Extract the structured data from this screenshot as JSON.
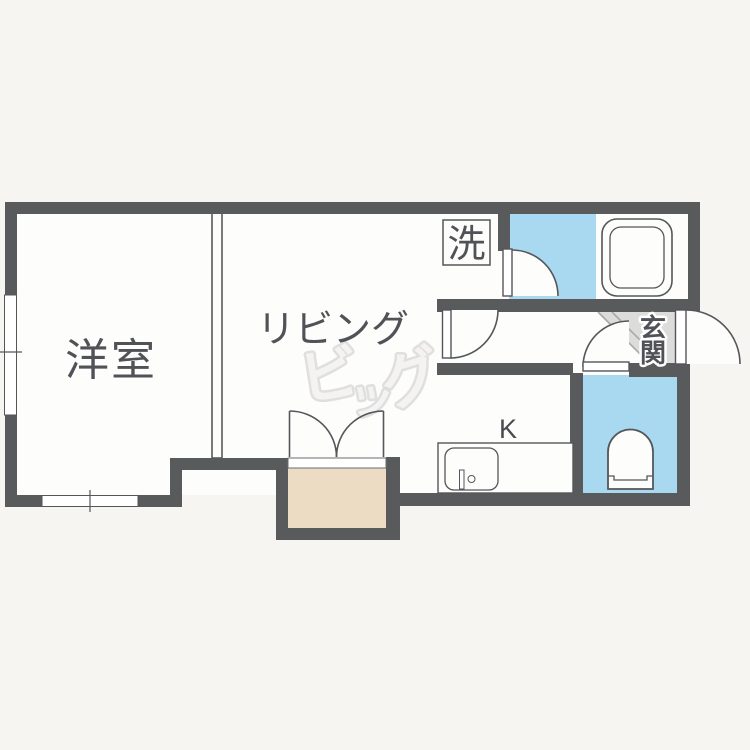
{
  "page": {
    "description": "Japanese apartment floor plan (1K/1LDK style)",
    "background": "#f6f5f2"
  },
  "colors": {
    "paper": "#f6f5f2",
    "room": "#fdfdfc",
    "wall": "#595a5c",
    "wet_blue": "#a9d9f1",
    "closet_tan": "#ecdcc4",
    "genkan_gray": "#dcdcda",
    "line": "#55565a",
    "label": "#515257",
    "watermark": "#dcdcdc"
  },
  "labels": {
    "western_room": "洋室",
    "living": "リビング",
    "kitchen": "K",
    "laundry": "洗",
    "entrance_top": "玄",
    "entrance_bottom": "関"
  },
  "watermark": {
    "full": "ビッグ",
    "char1": "ビ",
    "char2": "ッ",
    "char3": "グ"
  }
}
